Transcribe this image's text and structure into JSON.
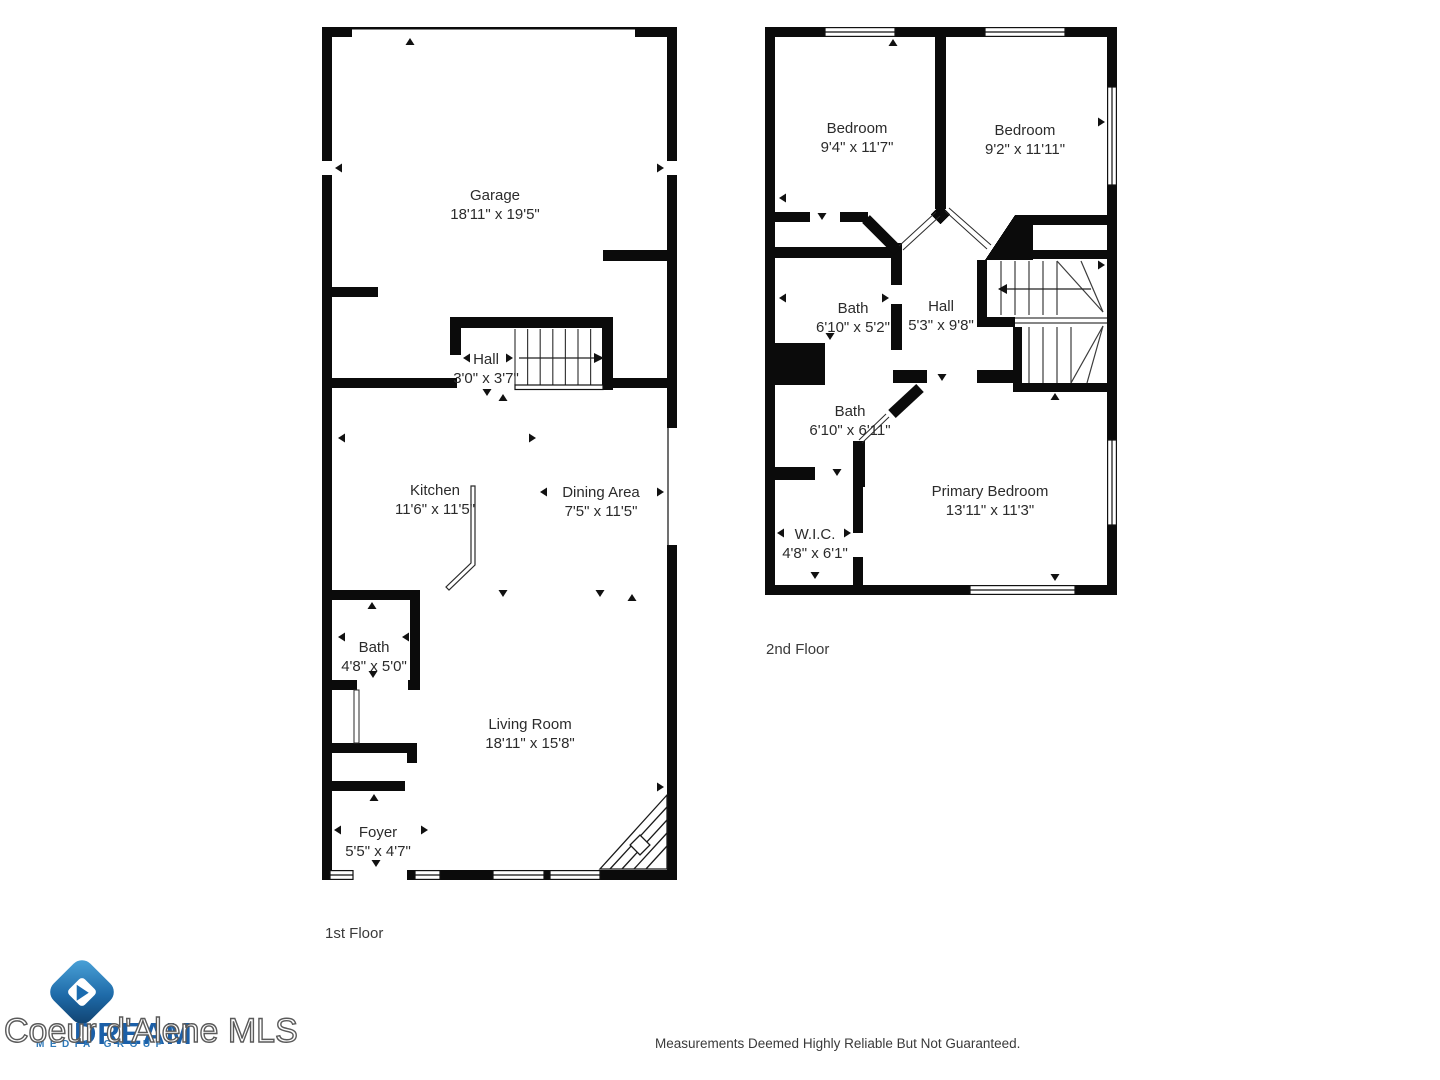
{
  "floors": [
    {
      "label": "1st Floor",
      "rooms": [
        {
          "name": "Garage",
          "dims": "18'11\" x 19'5\""
        },
        {
          "name": "Hall",
          "dims": "3'0\" x 3'7\""
        },
        {
          "name": "Kitchen",
          "dims": "11'6\" x 11'5\""
        },
        {
          "name": "Dining Area",
          "dims": "7'5\" x 11'5\""
        },
        {
          "name": "Bath",
          "dims": "4'8\" x 5'0\""
        },
        {
          "name": "Living Room",
          "dims": "18'11\" x 15'8\""
        },
        {
          "name": "Foyer",
          "dims": "5'5\" x 4'7\""
        }
      ]
    },
    {
      "label": "2nd Floor",
      "rooms": [
        {
          "name": "Bedroom",
          "dims": "9'4\" x 11'7\""
        },
        {
          "name": "Bedroom",
          "dims": "9'2\" x 11'11\""
        },
        {
          "name": "Bath",
          "dims": "6'10\" x 5'2\""
        },
        {
          "name": "Hall",
          "dims": "5'3\" x 9'8\""
        },
        {
          "name": "Bath",
          "dims": "6'10\" x 6'11\""
        },
        {
          "name": "Primary Bedroom",
          "dims": "13'11\" x 11'3\""
        },
        {
          "name": "W.I.C.",
          "dims": "4'8\" x 6'1\""
        }
      ]
    }
  ],
  "watermark": {
    "mls": "Coeur d'Alene MLS",
    "brand": "DREAM",
    "brand_sub": "MEDIA GROUP",
    "brand_color": "#1b5fa8",
    "logo_gradient_start": "#4fa8dd",
    "logo_gradient_end": "#0f3d68"
  },
  "footer": {
    "disclaimer": "Measurements Deemed Highly Reliable But Not Guaranteed."
  }
}
